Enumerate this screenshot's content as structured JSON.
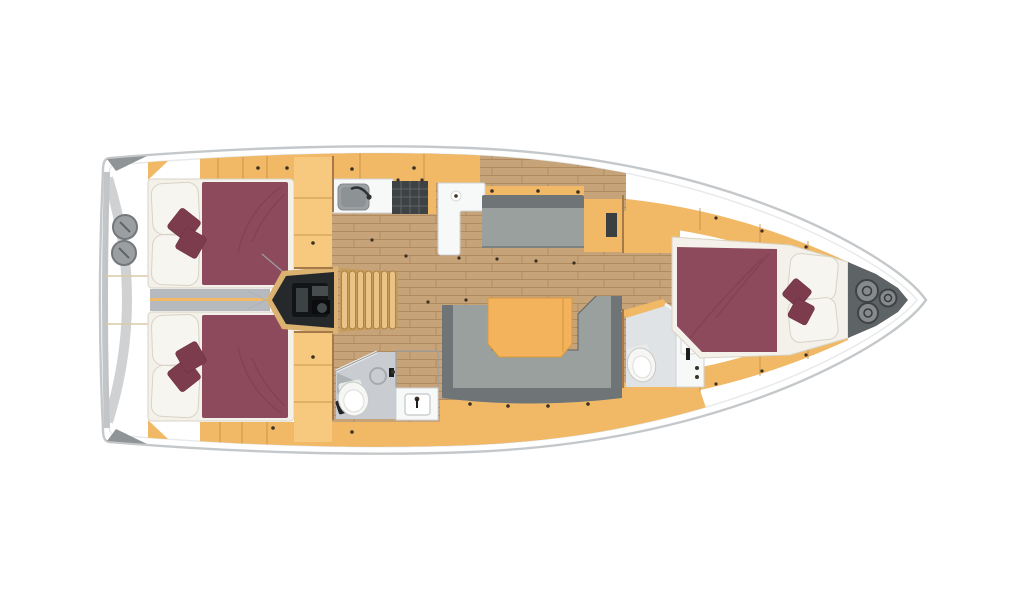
{
  "meta": {
    "title": "Sailing yacht interior layout plan, top view, bow to the right",
    "view": "top-down floor plan render",
    "visible_text": ""
  },
  "colors": {
    "page_bg": "#ffffff",
    "hull_fill": "#ffffff",
    "hull_stroke": "#c5c8ca",
    "deck_line": "#e7e9ea",
    "stern_cap": "#8f9496",
    "stern_arc": "#c3c6c8",
    "stern_edge": "#b9bcbe",
    "hatch_gray": "#9b9fa2",
    "hatch_ring": "#73787b",
    "wood_cabinet": "#f1b966",
    "wood_cabinet_light": "#f6c97f",
    "wood_edge": "#c08a43",
    "table_wood": "#f3b25c",
    "wood_floor": "#c7a37a",
    "wood_floor_line": "#b08b60",
    "stairs_base": "#c69c5a",
    "stairs_wood": "#ecc386",
    "stairs_line": "#a97f40",
    "bed_maroon": "#8c4a5c",
    "bed_crease": "#7a3f51",
    "cushion_red": "#7d3b4e",
    "bedding_white": "#f7f5ef",
    "bedding_shadow": "#d8d3c6",
    "mattress_white": "#f3f1e9",
    "sofa_seat": "#9aa09e",
    "sofa_back": "#6f7577",
    "sofa_edge": "#5d6365",
    "corridor_gray": "#b6b9bd",
    "engine_frame": "#dcb271",
    "engine_dark": "#26292b",
    "engine_detail": "#3d4245",
    "bath_floor": "#c9ccd0",
    "bath_floor_light": "#e0e3e5",
    "bath_wall": "#9ba0a3",
    "fixture_white": "#f7f8f8",
    "fixture_stroke": "#cfd2d3",
    "sink_gray": "#9aa0a3",
    "stove_dark": "#3e4245",
    "stove_grid": "#5f6467",
    "anchor_locker": "#5e6366",
    "hatch_dark": "#868a8c",
    "dot_dark": "#3a3024",
    "wall_line": "#a5794a"
  },
  "layout": {
    "orientation": "bow-right",
    "rooms": {
      "stern_deck": {
        "name": "Stern deck with transom arc and two round deck hatches"
      },
      "aft_cabin_port": {
        "name": "Port aft cabin with double berth, two pillows, two cushions, wardrobe"
      },
      "aft_cabin_starboard": {
        "name": "Starboard aft cabin with double berth, two pillows, two cushions, wardrobe"
      },
      "engine_compartment": {
        "name": "Engine compartment under companionway"
      },
      "companionway": {
        "name": "Companionway steps, seven treads"
      },
      "galley": {
        "name": "Galley with sink, stove and L-shaped counter"
      },
      "salon": {
        "name": "Salon with straight sofa, U-shaped sofa and folding table"
      },
      "aft_head": {
        "name": "Aft head with toilet, shower drain and corner basin"
      },
      "washroom": {
        "name": "Separate washbasin room"
      },
      "forward_head": {
        "name": "Forward head with toilet and vanity"
      },
      "forward_cabin": {
        "name": "Forward cabin with double berth, two pillows, two cushions"
      },
      "anchor_locker": {
        "name": "Bow anchor locker with three round hatches"
      }
    },
    "summary": {
      "berths": 3,
      "heads": 2,
      "stern_deck_hatches": 2,
      "bow_locker_hatches": 3,
      "companionway_steps": 7
    }
  }
}
